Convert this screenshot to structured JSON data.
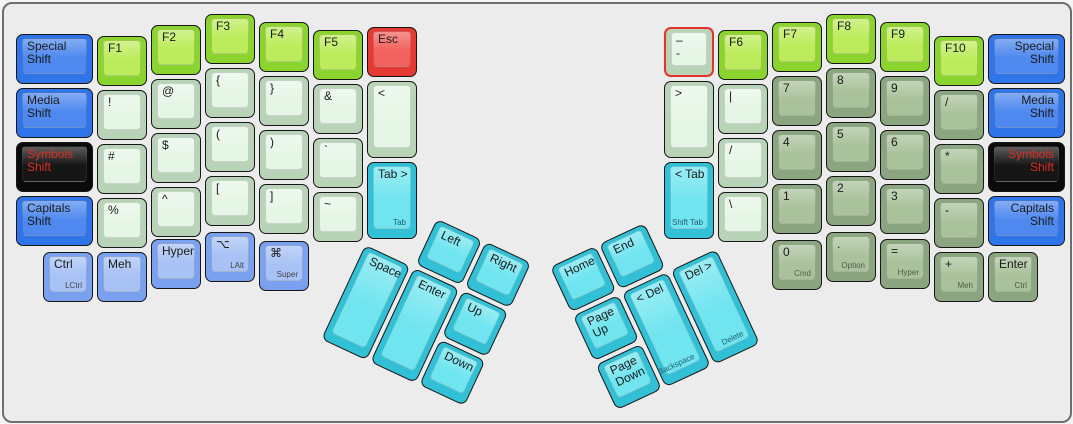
{
  "keyboard": {
    "canvas": {
      "background": "#ececec",
      "border_color": "#6e6e6e"
    },
    "palette": {
      "shift_blue": "#4f89ef",
      "modifier_light_blue": "#a8c2f5",
      "symbols_black": "#161616",
      "symbols_red_text": "#dc2f23",
      "function_green": "#bcec5c",
      "esc_red": "#f2625e",
      "symbol_pale_green": "#e6f6e6",
      "numpad_sage_green": "#a9c29b",
      "thumb_cyan": "#70e5f0",
      "selected_border_red": "#e4332a"
    },
    "keys": [
      {
        "name": "special-shift-left",
        "x": 12,
        "y": 30,
        "w": 77,
        "h": 50,
        "color": "blue",
        "labels": [
          "Special",
          "Shift"
        ]
      },
      {
        "name": "media-shift-left",
        "x": 12,
        "y": 84,
        "w": 77,
        "h": 50,
        "color": "blue",
        "labels": [
          "Media",
          "Shift"
        ]
      },
      {
        "name": "symbols-shift-left",
        "x": 12,
        "y": 138,
        "w": 77,
        "h": 50,
        "color": "black",
        "labels": [
          "Symbols",
          "Shift"
        ]
      },
      {
        "name": "capitals-shift-left",
        "x": 12,
        "y": 192,
        "w": 77,
        "h": 50,
        "color": "blue",
        "labels": [
          "Capitals",
          "Shift"
        ]
      },
      {
        "name": "f1",
        "x": 93,
        "y": 32,
        "w": 50,
        "h": 50,
        "color": "green",
        "labels": [
          "F1"
        ]
      },
      {
        "name": "exclamation",
        "x": 93,
        "y": 86,
        "w": 50,
        "h": 50,
        "color": "pale",
        "labels": [
          "!"
        ]
      },
      {
        "name": "hash",
        "x": 93,
        "y": 140,
        "w": 50,
        "h": 50,
        "color": "pale",
        "labels": [
          "#"
        ]
      },
      {
        "name": "percent",
        "x": 93,
        "y": 194,
        "w": 50,
        "h": 50,
        "color": "pale",
        "labels": [
          "%"
        ]
      },
      {
        "name": "f2",
        "x": 147,
        "y": 21,
        "w": 50,
        "h": 50,
        "color": "green",
        "labels": [
          "F2"
        ]
      },
      {
        "name": "at-sign",
        "x": 147,
        "y": 75,
        "w": 50,
        "h": 50,
        "color": "pale",
        "labels": [
          "@"
        ]
      },
      {
        "name": "dollar",
        "x": 147,
        "y": 129,
        "w": 50,
        "h": 50,
        "color": "pale",
        "labels": [
          "$"
        ]
      },
      {
        "name": "caret",
        "x": 147,
        "y": 183,
        "w": 50,
        "h": 50,
        "color": "pale",
        "labels": [
          "^"
        ]
      },
      {
        "name": "f3",
        "x": 201,
        "y": 10,
        "w": 50,
        "h": 50,
        "color": "green",
        "labels": [
          "F3"
        ]
      },
      {
        "name": "brace-open",
        "x": 201,
        "y": 64,
        "w": 50,
        "h": 50,
        "color": "pale",
        "labels": [
          "{"
        ]
      },
      {
        "name": "paren-open",
        "x": 201,
        "y": 118,
        "w": 50,
        "h": 50,
        "color": "pale",
        "labels": [
          "("
        ]
      },
      {
        "name": "bracket-open",
        "x": 201,
        "y": 172,
        "w": 50,
        "h": 50,
        "color": "pale",
        "labels": [
          "["
        ]
      },
      {
        "name": "f4",
        "x": 255,
        "y": 18,
        "w": 50,
        "h": 50,
        "color": "green",
        "labels": [
          "F4"
        ]
      },
      {
        "name": "brace-close",
        "x": 255,
        "y": 72,
        "w": 50,
        "h": 50,
        "color": "pale",
        "labels": [
          "}"
        ]
      },
      {
        "name": "paren-close",
        "x": 255,
        "y": 126,
        "w": 50,
        "h": 50,
        "color": "pale",
        "labels": [
          ")"
        ]
      },
      {
        "name": "bracket-close",
        "x": 255,
        "y": 180,
        "w": 50,
        "h": 50,
        "color": "pale",
        "labels": [
          "]"
        ]
      },
      {
        "name": "f5",
        "x": 309,
        "y": 26,
        "w": 50,
        "h": 50,
        "color": "green",
        "labels": [
          "F5"
        ]
      },
      {
        "name": "ampersand",
        "x": 309,
        "y": 80,
        "w": 50,
        "h": 50,
        "color": "pale",
        "labels": [
          "&"
        ]
      },
      {
        "name": "backtick",
        "x": 309,
        "y": 134,
        "w": 50,
        "h": 50,
        "color": "pale",
        "labels": [
          "`"
        ]
      },
      {
        "name": "tilde",
        "x": 309,
        "y": 188,
        "w": 50,
        "h": 50,
        "color": "pale",
        "labels": [
          "~"
        ]
      },
      {
        "name": "esc",
        "x": 363,
        "y": 23,
        "w": 50,
        "h": 50,
        "color": "red",
        "labels": [
          "Esc"
        ]
      },
      {
        "name": "less-than",
        "x": 363,
        "y": 77,
        "w": 50,
        "h": 77,
        "color": "pale",
        "labels": [
          "<"
        ]
      },
      {
        "name": "tab-forward",
        "x": 363,
        "y": 158,
        "w": 50,
        "h": 77,
        "color": "cyan",
        "labels": [
          "Tab >"
        ],
        "sub": "Tab"
      },
      {
        "name": "lctrl",
        "x": 39,
        "y": 248,
        "w": 50,
        "h": 50,
        "color": "lightblue",
        "labels": [
          "Ctrl"
        ],
        "sub": "LCtrl"
      },
      {
        "name": "meh",
        "x": 93,
        "y": 248,
        "w": 50,
        "h": 50,
        "color": "lightblue",
        "labels": [
          "Meh"
        ]
      },
      {
        "name": "hyper-left",
        "x": 147,
        "y": 235,
        "w": 50,
        "h": 50,
        "color": "lightblue",
        "labels": [
          "Hyper"
        ]
      },
      {
        "name": "lalt",
        "x": 201,
        "y": 228,
        "w": 50,
        "h": 50,
        "color": "lightblue",
        "labels": [
          "⌥"
        ],
        "sub": "LAlt"
      },
      {
        "name": "super",
        "x": 255,
        "y": 237,
        "w": 50,
        "h": 50,
        "color": "lightblue",
        "labels": [
          "⌘"
        ],
        "sub": "Super"
      },
      {
        "name": "dash-selected",
        "x": 660,
        "y": 23,
        "w": 50,
        "h": 50,
        "color": "pale",
        "labels": [
          "–",
          "-"
        ],
        "selected": true
      },
      {
        "name": "greater-than",
        "x": 660,
        "y": 77,
        "w": 50,
        "h": 77,
        "color": "pale",
        "labels": [
          ">"
        ]
      },
      {
        "name": "shift-tab",
        "x": 660,
        "y": 158,
        "w": 50,
        "h": 77,
        "color": "cyan",
        "labels": [
          "< Tab"
        ],
        "sub": "Shift Tab"
      },
      {
        "name": "f6",
        "x": 714,
        "y": 26,
        "w": 50,
        "h": 50,
        "color": "green",
        "labels": [
          "F6"
        ]
      },
      {
        "name": "pipe",
        "x": 714,
        "y": 80,
        "w": 50,
        "h": 50,
        "color": "pale",
        "labels": [
          "|"
        ]
      },
      {
        "name": "slash",
        "x": 714,
        "y": 134,
        "w": 50,
        "h": 50,
        "color": "pale",
        "labels": [
          "/"
        ]
      },
      {
        "name": "backslash",
        "x": 714,
        "y": 188,
        "w": 50,
        "h": 50,
        "color": "pale",
        "labels": [
          "\\"
        ]
      },
      {
        "name": "f7",
        "x": 768,
        "y": 18,
        "w": 50,
        "h": 50,
        "color": "green",
        "labels": [
          "F7"
        ]
      },
      {
        "name": "num-7",
        "x": 768,
        "y": 72,
        "w": 50,
        "h": 50,
        "color": "sage",
        "labels": [
          "7"
        ]
      },
      {
        "name": "num-4",
        "x": 768,
        "y": 126,
        "w": 50,
        "h": 50,
        "color": "sage",
        "labels": [
          "4"
        ]
      },
      {
        "name": "num-1",
        "x": 768,
        "y": 180,
        "w": 50,
        "h": 50,
        "color": "sage",
        "labels": [
          "1"
        ]
      },
      {
        "name": "num-0",
        "x": 768,
        "y": 236,
        "w": 50,
        "h": 50,
        "color": "sage",
        "labels": [
          "0"
        ],
        "sub": "Cmd"
      },
      {
        "name": "f8",
        "x": 822,
        "y": 10,
        "w": 50,
        "h": 50,
        "color": "green",
        "labels": [
          "F8"
        ]
      },
      {
        "name": "num-8",
        "x": 822,
        "y": 64,
        "w": 50,
        "h": 50,
        "color": "sage",
        "labels": [
          "8"
        ]
      },
      {
        "name": "num-5",
        "x": 822,
        "y": 118,
        "w": 50,
        "h": 50,
        "color": "sage",
        "labels": [
          "5"
        ]
      },
      {
        "name": "num-2",
        "x": 822,
        "y": 172,
        "w": 50,
        "h": 50,
        "color": "sage",
        "labels": [
          "2"
        ]
      },
      {
        "name": "num-dot",
        "x": 822,
        "y": 228,
        "w": 50,
        "h": 50,
        "color": "sage",
        "labels": [
          "."
        ],
        "sub": "Option"
      },
      {
        "name": "f9",
        "x": 876,
        "y": 18,
        "w": 50,
        "h": 50,
        "color": "green",
        "labels": [
          "F9"
        ]
      },
      {
        "name": "num-9",
        "x": 876,
        "y": 72,
        "w": 50,
        "h": 50,
        "color": "sage",
        "labels": [
          "9"
        ]
      },
      {
        "name": "num-6",
        "x": 876,
        "y": 126,
        "w": 50,
        "h": 50,
        "color": "sage",
        "labels": [
          "6"
        ]
      },
      {
        "name": "num-3",
        "x": 876,
        "y": 180,
        "w": 50,
        "h": 50,
        "color": "sage",
        "labels": [
          "3"
        ]
      },
      {
        "name": "equals",
        "x": 876,
        "y": 235,
        "w": 50,
        "h": 50,
        "color": "sage",
        "labels": [
          "="
        ],
        "sub": "Hyper"
      },
      {
        "name": "f10",
        "x": 930,
        "y": 32,
        "w": 50,
        "h": 50,
        "color": "green",
        "labels": [
          "F10"
        ]
      },
      {
        "name": "numpad-slash",
        "x": 930,
        "y": 86,
        "w": 50,
        "h": 50,
        "color": "sage",
        "labels": [
          "/"
        ]
      },
      {
        "name": "asterisk",
        "x": 930,
        "y": 140,
        "w": 50,
        "h": 50,
        "color": "sage",
        "labels": [
          "*"
        ]
      },
      {
        "name": "minus",
        "x": 930,
        "y": 194,
        "w": 50,
        "h": 50,
        "color": "sage",
        "labels": [
          "-"
        ]
      },
      {
        "name": "plus",
        "x": 930,
        "y": 248,
        "w": 50,
        "h": 50,
        "color": "sage",
        "labels": [
          "+"
        ],
        "sub": "Meh"
      },
      {
        "name": "special-shift-right",
        "x": 984,
        "y": 30,
        "w": 77,
        "h": 50,
        "color": "blue",
        "labels": [
          "Special",
          "Shift"
        ],
        "align": "right"
      },
      {
        "name": "media-shift-right",
        "x": 984,
        "y": 84,
        "w": 77,
        "h": 50,
        "color": "blue",
        "labels": [
          "Media",
          "Shift"
        ],
        "align": "right"
      },
      {
        "name": "symbols-shift-right",
        "x": 984,
        "y": 138,
        "w": 77,
        "h": 50,
        "color": "black",
        "labels": [
          "Symbols",
          "Shift"
        ],
        "align": "right"
      },
      {
        "name": "capitals-shift-right",
        "x": 984,
        "y": 192,
        "w": 77,
        "h": 50,
        "color": "blue",
        "labels": [
          "Capitals",
          "Shift"
        ],
        "align": "right"
      },
      {
        "name": "enter-right",
        "x": 984,
        "y": 248,
        "w": 50,
        "h": 50,
        "color": "sage",
        "labels": [
          "Enter"
        ],
        "sub": "Ctrl"
      }
    ],
    "clusters": [
      {
        "name": "left-thumb-cluster",
        "x": 384,
        "y": 192,
        "rotation": 25,
        "keys": [
          {
            "name": "left-arrow",
            "x": 54,
            "y": 0,
            "w": 50,
            "h": 50,
            "color": "cyan",
            "labels": [
              "Left"
            ]
          },
          {
            "name": "right-arrow",
            "x": 108,
            "y": 0,
            "w": 50,
            "h": 50,
            "color": "cyan",
            "labels": [
              "Right"
            ]
          },
          {
            "name": "space",
            "x": 0,
            "y": 54,
            "w": 50,
            "h": 104,
            "color": "cyan",
            "labels": [
              "Space"
            ]
          },
          {
            "name": "enter-thumb",
            "x": 54,
            "y": 54,
            "w": 50,
            "h": 104,
            "color": "cyan",
            "labels": [
              "Enter"
            ]
          },
          {
            "name": "up-arrow",
            "x": 108,
            "y": 54,
            "w": 50,
            "h": 50,
            "color": "cyan",
            "labels": [
              "Up"
            ]
          },
          {
            "name": "down-arrow",
            "x": 108,
            "y": 108,
            "w": 50,
            "h": 50,
            "color": "cyan",
            "labels": [
              "Down"
            ]
          }
        ]
      },
      {
        "name": "right-thumb-cluster",
        "x": 546,
        "y": 263,
        "rotation": -25,
        "keys": [
          {
            "name": "home",
            "x": 0,
            "y": 0,
            "w": 50,
            "h": 50,
            "color": "cyan",
            "labels": [
              "Home"
            ]
          },
          {
            "name": "end",
            "x": 54,
            "y": 0,
            "w": 50,
            "h": 50,
            "color": "cyan",
            "labels": [
              "End"
            ]
          },
          {
            "name": "page-up",
            "x": 0,
            "y": 54,
            "w": 50,
            "h": 50,
            "color": "cyan",
            "labels": [
              "Page",
              "Up"
            ]
          },
          {
            "name": "backspace",
            "x": 54,
            "y": 54,
            "w": 50,
            "h": 104,
            "color": "cyan",
            "labels": [
              "< Del"
            ],
            "sub": "Backspace"
          },
          {
            "name": "delete",
            "x": 108,
            "y": 54,
            "w": 50,
            "h": 104,
            "color": "cyan",
            "labels": [
              "Del >"
            ],
            "sub": "Delete"
          },
          {
            "name": "page-down",
            "x": 0,
            "y": 108,
            "w": 50,
            "h": 50,
            "color": "cyan",
            "labels": [
              "Page",
              "Down"
            ]
          }
        ]
      }
    ]
  }
}
